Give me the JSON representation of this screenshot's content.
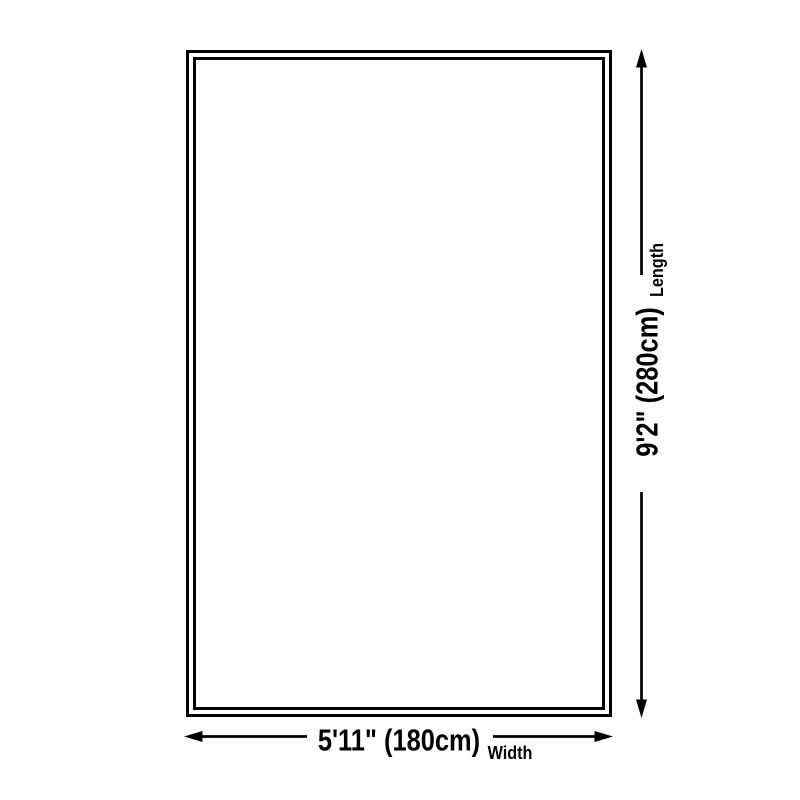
{
  "diagram": {
    "background_color": "#ffffff",
    "line_color": "#000000",
    "text_color": "#000000",
    "rug": {
      "shape": "rectangle",
      "outline_style": "double"
    },
    "length_dimension": {
      "value": "9'2\" (280cm)",
      "axis_label": "Length",
      "arrow_icon": "vertical-double-headed-arrow"
    },
    "width_dimension": {
      "value": "5'11\" (180cm)",
      "axis_label": "Width",
      "arrow_icon": "horizontal-double-headed-arrow"
    }
  }
}
